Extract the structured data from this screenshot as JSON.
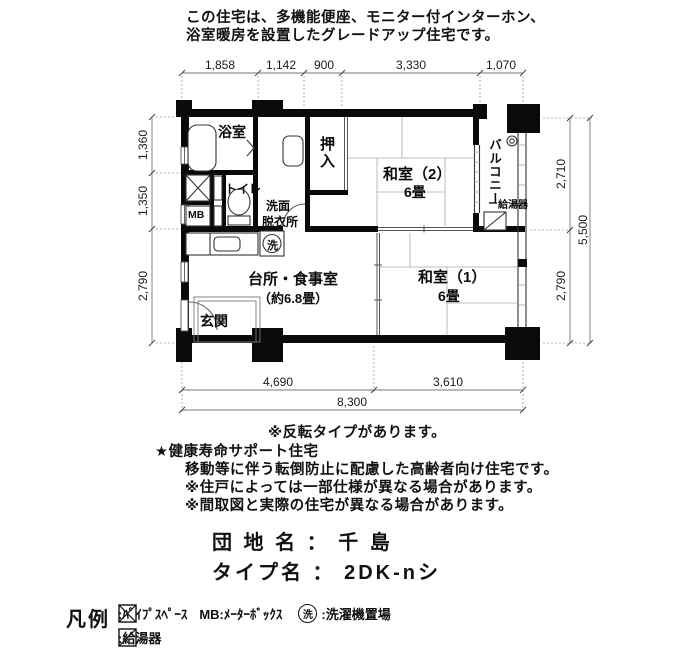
{
  "header": {
    "line1": "この住宅は、多機能便座、モニター付インターホン、",
    "line2": "浴室暖房を設置したグレードアップ住宅です。"
  },
  "plan": {
    "rooms": {
      "bath": "浴室",
      "toilet": "トイレ",
      "washroom_line1": "洗面",
      "washroom_line2": "脱衣所",
      "mb": "MB",
      "closet": "押入",
      "jp_room2": "和室（2）",
      "jp_room2_size": "6畳",
      "jp_room1": "和室（1）",
      "jp_room1_size": "6畳",
      "kitchen": "台所・食事室",
      "kitchen_size": "（約6.8畳）",
      "entrance": "玄関",
      "balcony": "バルコニー",
      "water_heater": "給湯器",
      "washer_symbol": "洗"
    },
    "dimensions": {
      "top": [
        "1,858",
        "1,142",
        "900",
        "3,330",
        "1,070"
      ],
      "bottom": [
        "4,690",
        "3,610"
      ],
      "bottom_total": "8,300",
      "left": [
        "1,360",
        "1,350",
        "2,790"
      ],
      "right": [
        "2,710",
        "2,790"
      ],
      "right_total": "5,500"
    }
  },
  "notes": [
    "※反転タイプがあります。",
    "★健康寿命サポート住宅",
    "移動等に伴う転倒防止に配慮した高齢者向け住宅です。",
    "※住戸によっては一部仕様が異なる場合があります。",
    "※間取図と実際の住宅が異なる場合があります。"
  ],
  "estate": {
    "danchi_line": "団 地 名 ： 千 島",
    "type_line": "タイプ名 ： 2DK-nシ"
  },
  "legend": {
    "title": "凡例",
    "pipe_space_label": ":ﾊﾟｲﾌﾟｽﾍﾟｰｽ",
    "mb_label": "MB:ﾒｰﾀｰﾎﾞｯｸｽ",
    "washer_circle_char": "洗",
    "washer_label": ":洗濯機置場",
    "heater_label": ":給湯器"
  },
  "colors": {
    "ink": "#0a0a0a",
    "line": "#555555",
    "thin": "#999999"
  }
}
